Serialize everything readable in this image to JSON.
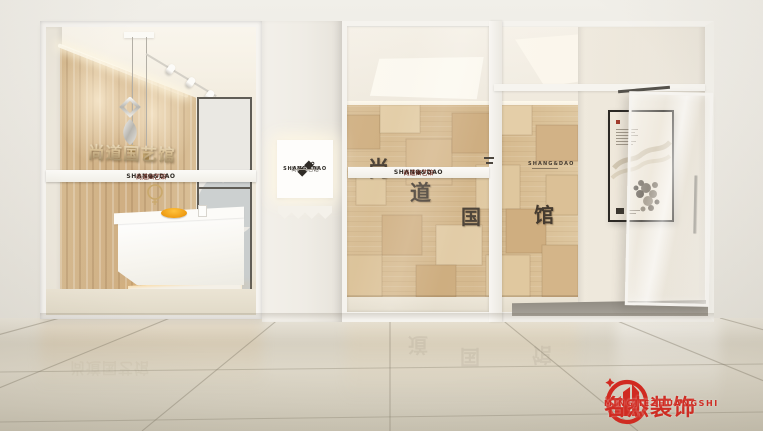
{
  "brand": {
    "tape_cn": "·尚道国艺馆·",
    "tape_en": "SHANG&DAO",
    "tape_diamond": "◈",
    "wall_letters_3d": "尚道国艺馆",
    "wall_letters_sub": "SHANG&DAO",
    "wall_characters": [
      "尚",
      "道",
      "国",
      "馆"
    ],
    "wall_small_text": "SHANG&DAO",
    "lightbox": {
      "cn": "·尚道国艺馆·",
      "en": "SHANG&DAO"
    }
  },
  "watermark": {
    "name_cn": "名杰装饰",
    "registered": "®",
    "name_en": "MINGJIEZHUANGSHI",
    "color": "#d5281f"
  },
  "palette": {
    "fascia_wall": "#e8e5de",
    "wood_light": "#e2cba4",
    "wood_base": "#d8bd93",
    "wood_dark": "#c9a97a",
    "tape_bg": "#f8f6f2",
    "tape_text_cn": "#6e2a20",
    "tape_text_en": "#2f2b26",
    "wall_char_color": "#453b30",
    "accent_orange": "#f2a51f",
    "floor": "#d7d1c2"
  }
}
